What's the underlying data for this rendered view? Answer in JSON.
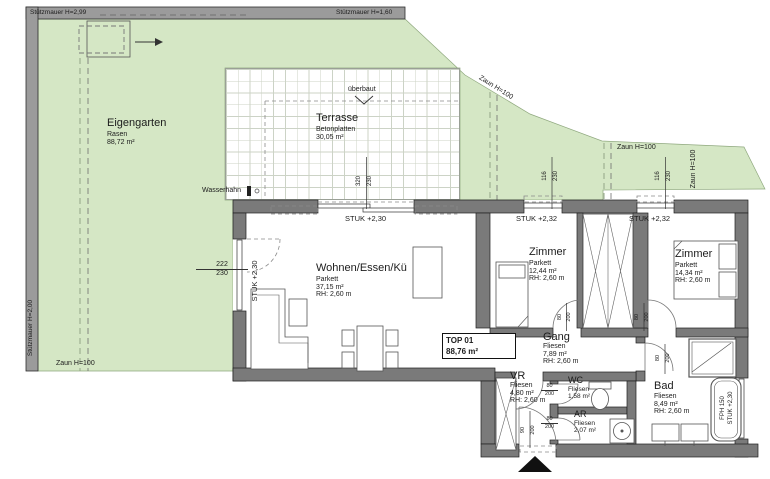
{
  "site": {
    "retaining_wall_top_left": "Stützmauer H=2,99",
    "retaining_wall_top_right": "Stützmauer H=1,60",
    "retaining_wall_left": "Stützmauer H=2,00",
    "fence_left": "Zaun H=100",
    "fence_slope": "Zaun H=100",
    "fence_mid": "Zaun H=100",
    "fence_right": "Zaun H=100",
    "garden_name": "Eigengarten",
    "garden_surface": "Rasen",
    "garden_area": "88,72 m²",
    "terrace_name": "Terrasse",
    "terrace_surface": "Betonplatten",
    "terrace_area": "30,05 m²",
    "overbuilt": "überbaut",
    "water_tap": "Wasserhahn"
  },
  "unit": {
    "id": "TOP 01",
    "area": "88,76 m²"
  },
  "rooms": {
    "wohnen": {
      "name": "Wohnen/Essen/Kü",
      "floor": "Parkett",
      "area": "37,15 m²",
      "height": "RH: 2,60 m"
    },
    "zimmer1": {
      "name": "Zimmer",
      "floor": "Parkett",
      "area": "12,44 m²",
      "height": "RH: 2,60 m"
    },
    "zimmer2": {
      "name": "Zimmer",
      "floor": "Parkett",
      "area": "14,34 m²",
      "height": "RH: 2,60 m"
    },
    "gang": {
      "name": "Gang",
      "floor": "Fliesen",
      "area": "7,89 m²",
      "height": "RH: 2,60 m"
    },
    "vr": {
      "name": "VR",
      "floor": "Fliesen",
      "area": "4,80 m²",
      "height": "RH: 2,60 m"
    },
    "wc": {
      "name": "WC",
      "floor": "Fliesen",
      "area": "1,58 m²"
    },
    "ar": {
      "name": "AR",
      "floor": "Fliesen",
      "area": "2,07 m²"
    },
    "bad": {
      "name": "Bad",
      "floor": "Fliesen",
      "area": "8,49 m²",
      "height": "RH: 2,60 m"
    }
  },
  "lintels": {
    "terrace_door": "STUK +2,30",
    "left_door": "STUK +2,30",
    "window1": "STUK +2,32",
    "window2": "STUK +2,32"
  },
  "bathtub": {
    "model": "FPH 150",
    "lintel": "STUK +2,30"
  },
  "dims": {
    "terrace_door_w": "320",
    "terrace_door_h": "230",
    "window1_w": "116",
    "window1_h": "230",
    "window2_w": "116",
    "window2_h": "230",
    "left_door_w": "222",
    "left_door_h": "230",
    "door_w": "80",
    "door_h": "200",
    "entrance_w": "90",
    "entrance_h": "200"
  },
  "colors": {
    "garden": "#d5e7c5",
    "wall": "#7a7a7a",
    "band": "#9b9b9b"
  }
}
